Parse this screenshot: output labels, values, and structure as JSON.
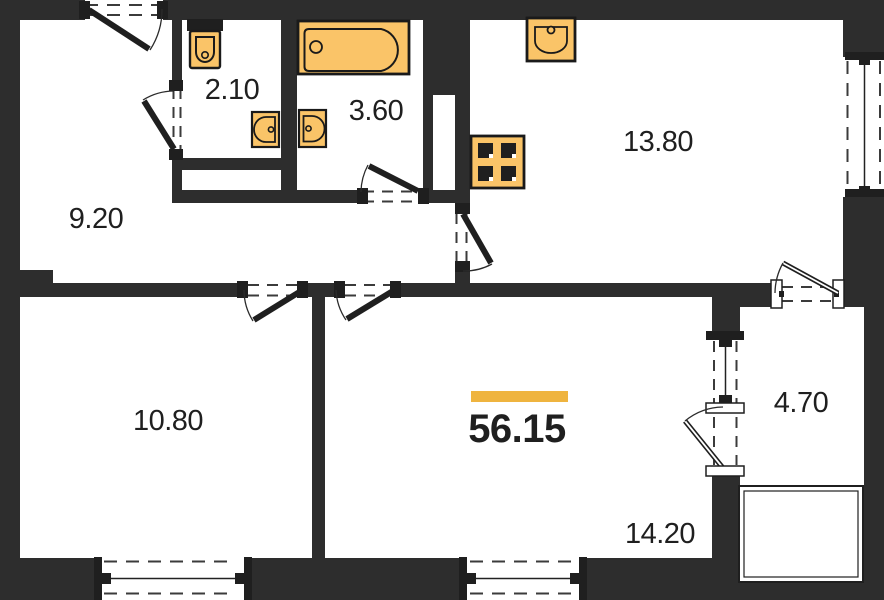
{
  "title": "Apartment floor plan",
  "total": {
    "area": "56.15"
  },
  "rooms": [
    {
      "id": "hallway",
      "area": "9.20"
    },
    {
      "id": "wc",
      "area": "2.10"
    },
    {
      "id": "bathroom",
      "area": "3.60"
    },
    {
      "id": "kitchen",
      "area": "13.80"
    },
    {
      "id": "bedroom",
      "area": "10.80"
    },
    {
      "id": "living-room",
      "area": "14.20"
    },
    {
      "id": "balcony",
      "area": "4.70"
    }
  ],
  "fixtures": [
    "toilet",
    "bathtub",
    "wc-sink",
    "bathroom-sink",
    "kitchen-sink",
    "stove"
  ],
  "openings": [
    "entrance-door",
    "wc-door",
    "bathroom-door",
    "kitchen-door",
    "bedroom-door",
    "living-room-door",
    "balcony-door",
    "balcony-window",
    "kitchen-window",
    "bedroom-window",
    "living-room-window",
    "balcony-top-window"
  ],
  "colors": {
    "wall": "#2d2d2d",
    "fixture_fill": "#FAC468",
    "fixture_stroke": "#1a1a1a",
    "accent_bar": "#EFB43F",
    "label_text": "#1f1f1f",
    "background": "#ffffff"
  }
}
